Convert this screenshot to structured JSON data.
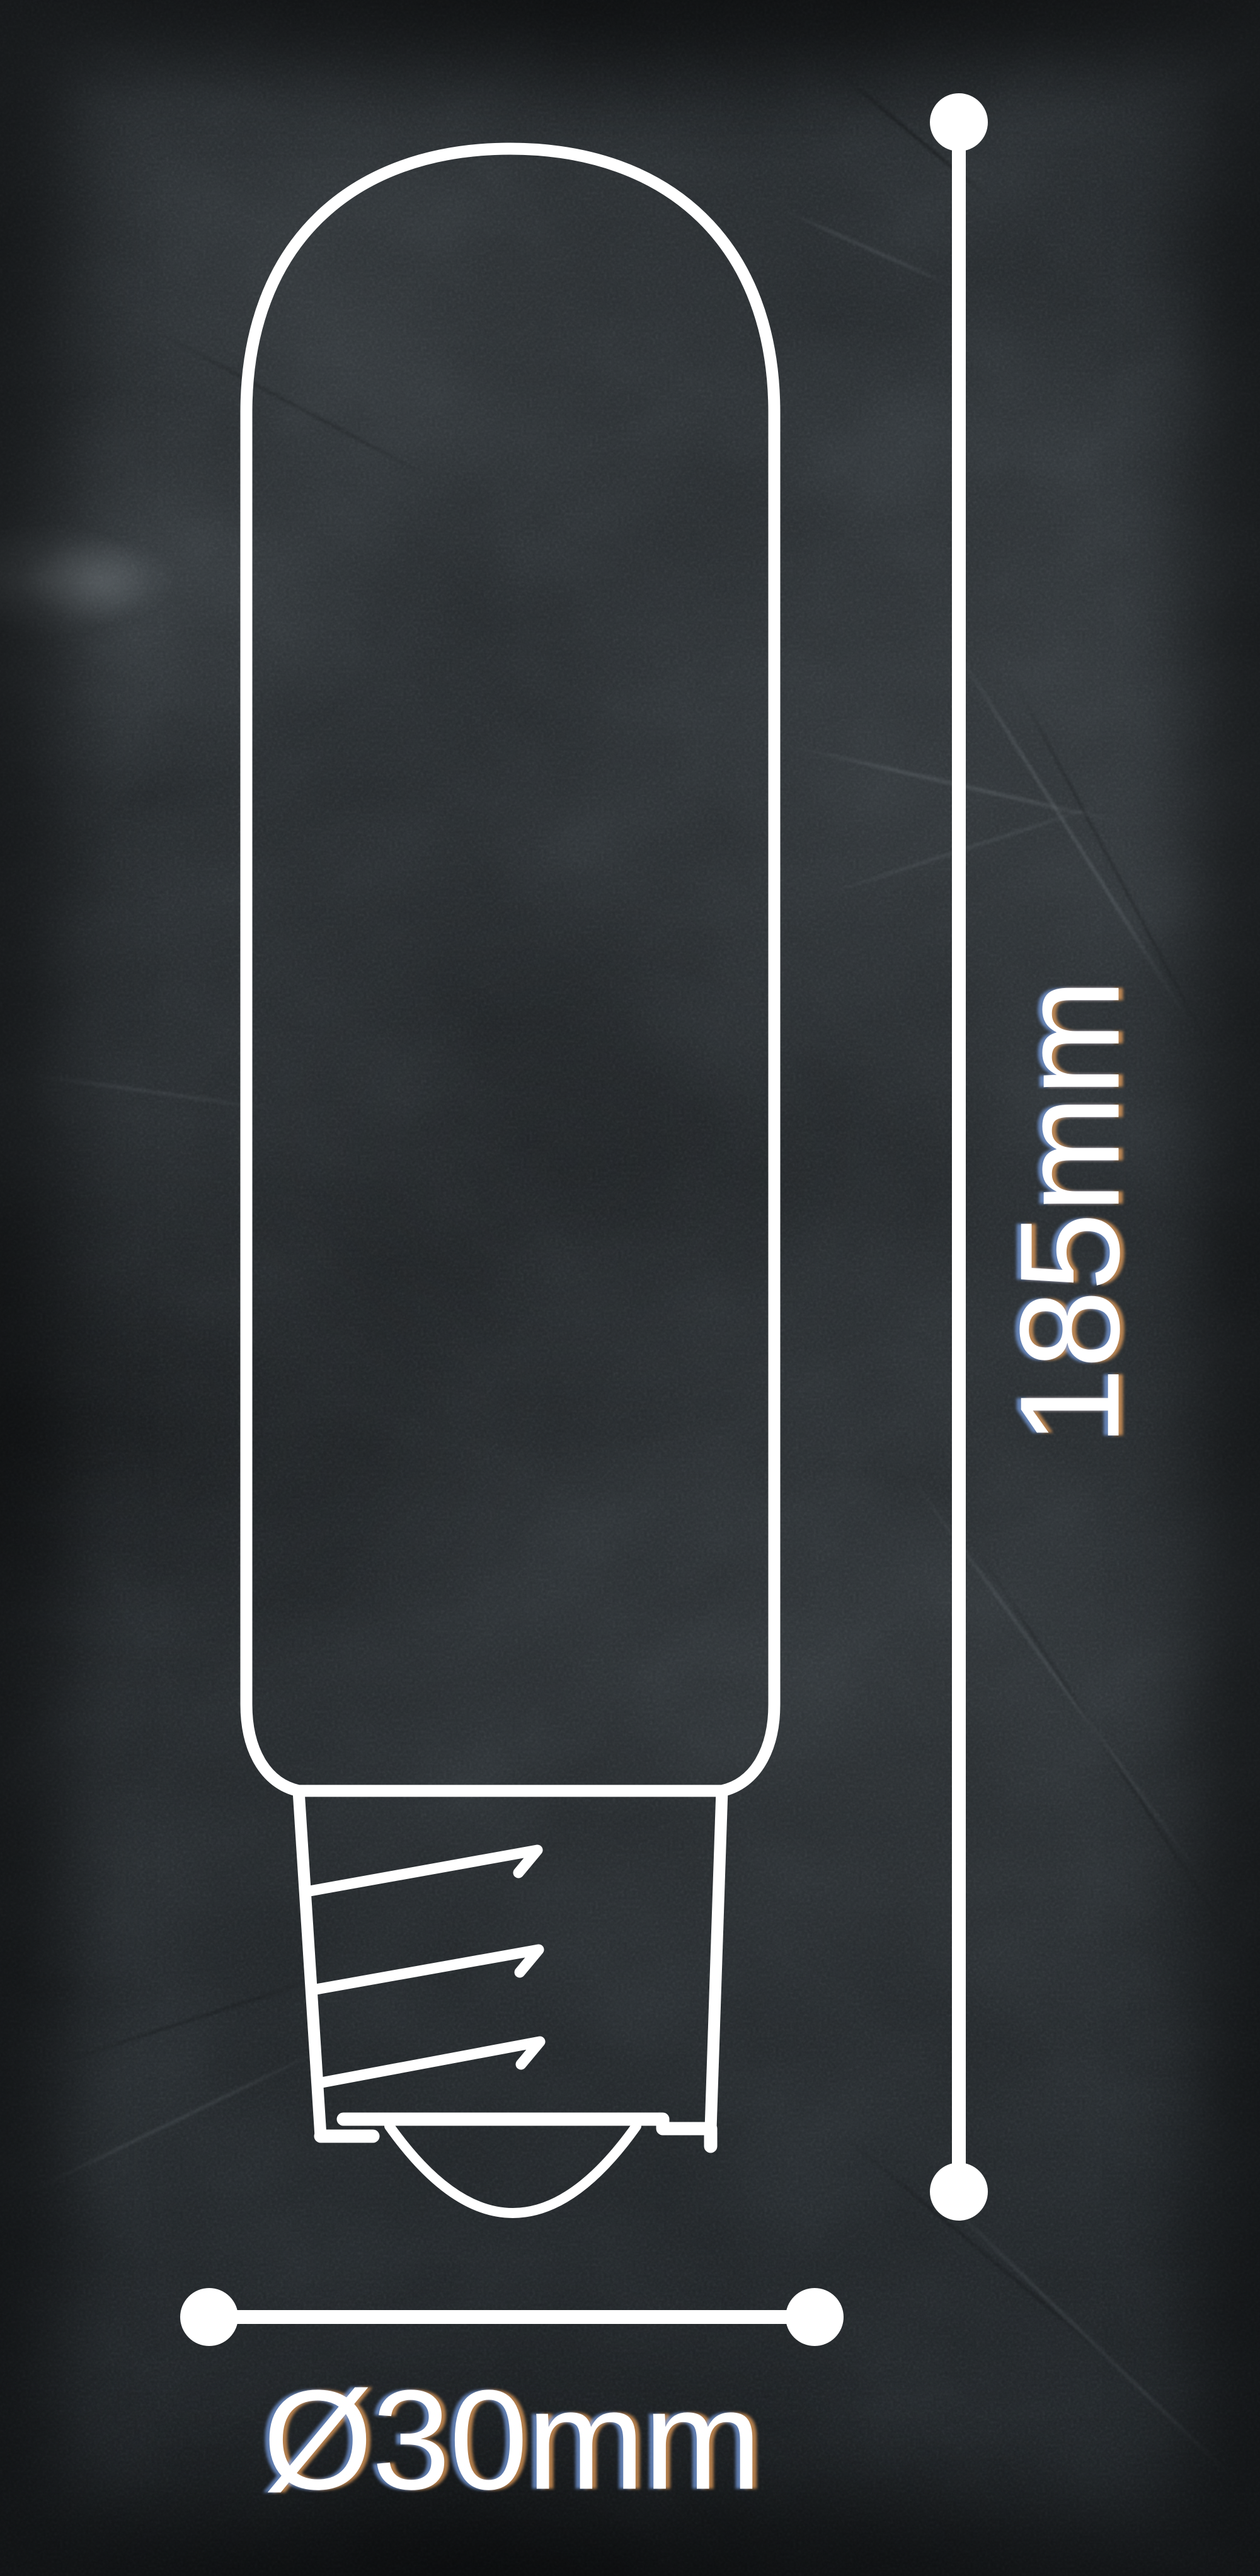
{
  "scene": {
    "description": "White line-art dimension drawing of a tubular filament bulb with a screw base on a dark grunge concrete background",
    "background_color": "#212528",
    "line_color": "#ffffff",
    "fringe_left_color": "#7da5eb",
    "fringe_right_color": "#f2a55c"
  },
  "drawing": {
    "subject": "tubular-bulb-outline",
    "parts": [
      "glass-tube",
      "screw-base",
      "screw-threads",
      "base-bottom-contact"
    ]
  },
  "dimensions": {
    "height": {
      "label": "185mm",
      "orientation": "vertical"
    },
    "diameter": {
      "label": "Ø30mm",
      "orientation": "horizontal"
    }
  }
}
